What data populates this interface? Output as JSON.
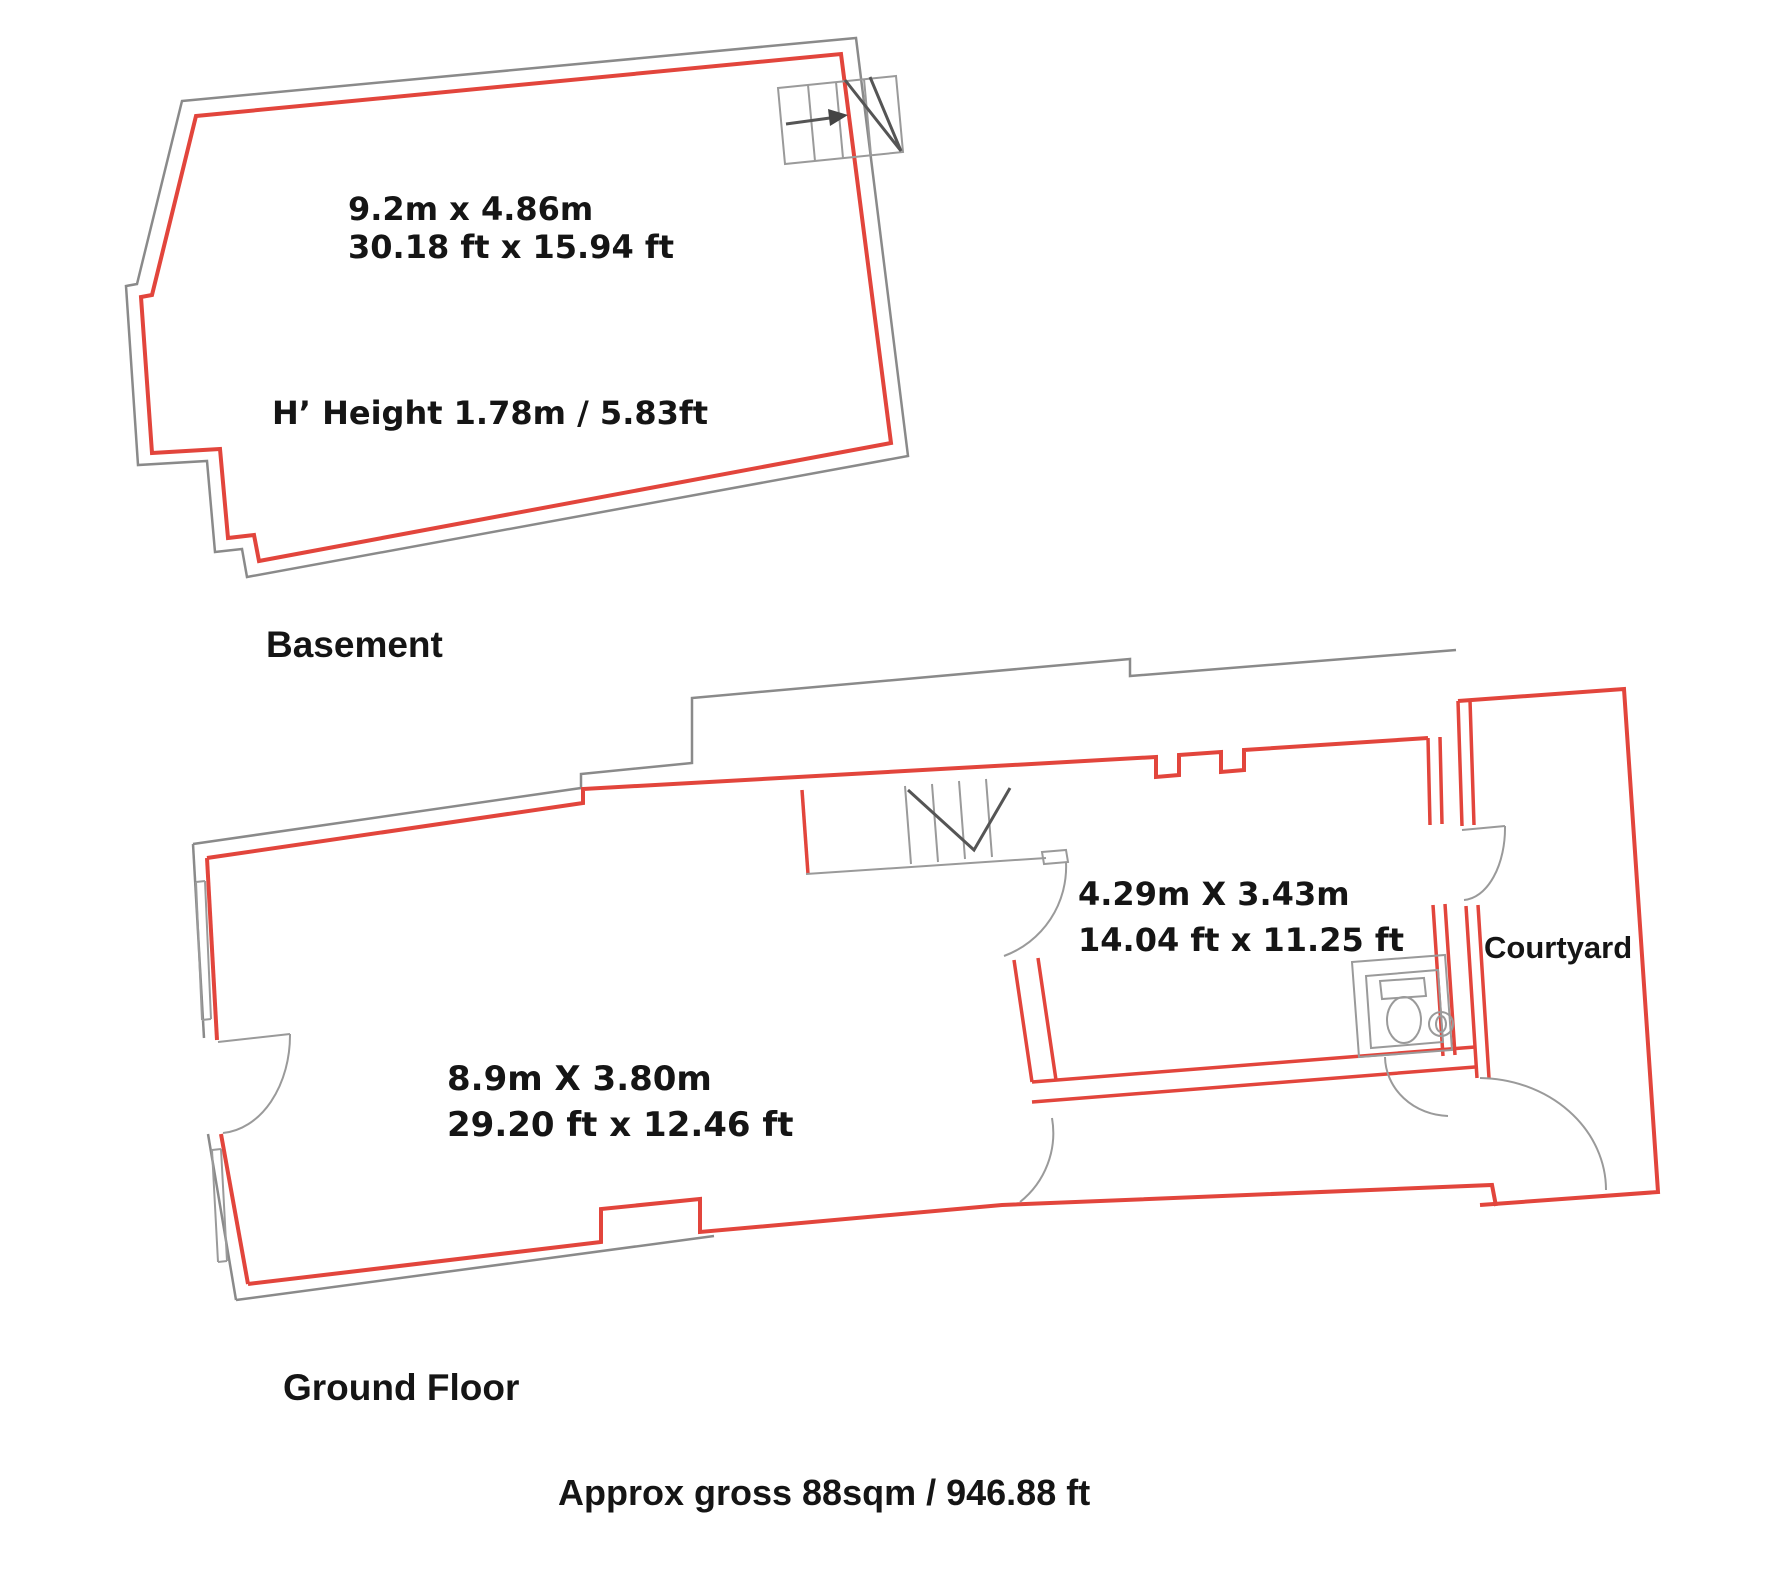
{
  "colors": {
    "plan_outline_red": "#e2453c",
    "wall_gray": "#8a8a8a",
    "label_text": "#151515",
    "background": "#ffffff"
  },
  "basement": {
    "label": "Basement",
    "dimensions_metric": "9.2m x 4.86m",
    "dimensions_imperial": "30.18 ft x 15.94 ft",
    "ceiling_height": "H’ Height 1.78m / 5.83ft"
  },
  "ground_floor": {
    "label": "Ground Floor",
    "main_room": {
      "dimensions_metric": "8.9m X 3.80m",
      "dimensions_imperial": "29.20 ft x 12.46 ft"
    },
    "rear_room": {
      "dimensions_metric": "4.29m X 3.43m",
      "dimensions_imperial": "14.04 ft x 11.25 ft"
    },
    "courtyard_label": "Courtyard"
  },
  "summary": {
    "approx_gross_area": "Approx gross 88sqm / 946.88 ft"
  }
}
